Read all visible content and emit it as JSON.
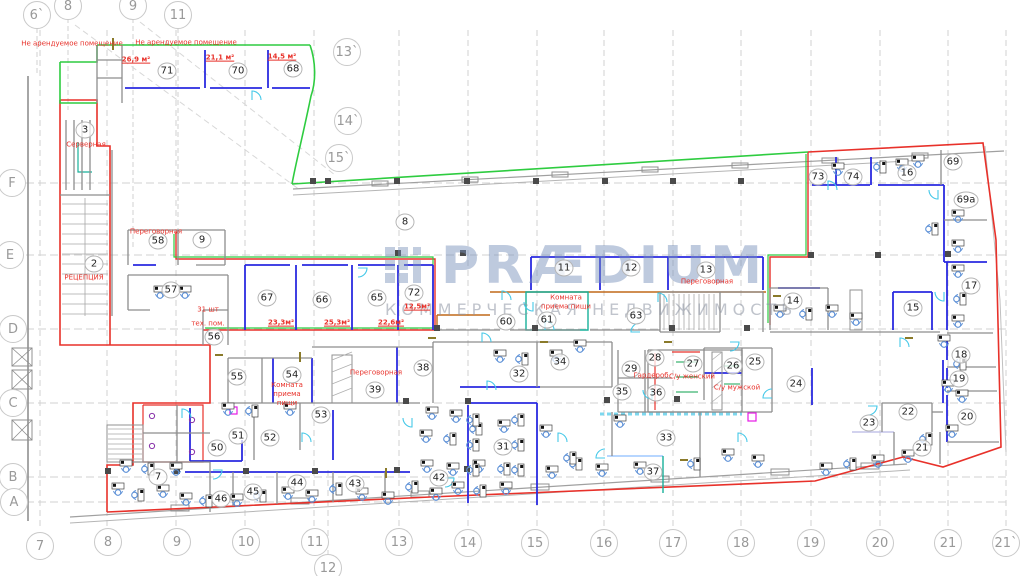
{
  "watermark": {
    "brand": "PRÆDIUM",
    "subtitle": "КОММЕРЧЕСКАЯ НЕДВИЖИМОСТЬ"
  },
  "colors": {
    "lease_boundary_red": "#e8312a",
    "tenant_boundary_green": "#2ecc40",
    "partition_blue": "#2a2ae0",
    "corridor_orange": "#c06818",
    "furniture_blue": "#5b8fd6",
    "door_cyan": "#45c8e8",
    "annotation_red": "#e8312a",
    "grid_gray": "#c9c9c9"
  },
  "grid_axes": [
    {
      "t": "6`",
      "x": 37,
      "y": 15
    },
    {
      "t": "8",
      "x": 68,
      "y": 6
    },
    {
      "t": "9",
      "x": 133,
      "y": 6
    },
    {
      "t": "11",
      "x": 178,
      "y": 15
    },
    {
      "t": "13`",
      "x": 347,
      "y": 52
    },
    {
      "t": "14`",
      "x": 348,
      "y": 121
    },
    {
      "t": "15`",
      "x": 339,
      "y": 158
    },
    {
      "t": "7",
      "x": 40,
      "y": 546
    },
    {
      "t": "8",
      "x": 108,
      "y": 542
    },
    {
      "t": "9",
      "x": 177,
      "y": 542
    },
    {
      "t": "10",
      "x": 246,
      "y": 542
    },
    {
      "t": "11",
      "x": 315,
      "y": 542
    },
    {
      "t": "12",
      "x": 328,
      "y": 568
    },
    {
      "t": "13",
      "x": 399,
      "y": 542
    },
    {
      "t": "14",
      "x": 468,
      "y": 543
    },
    {
      "t": "15",
      "x": 535,
      "y": 543
    },
    {
      "t": "16",
      "x": 604,
      "y": 543
    },
    {
      "t": "17",
      "x": 673,
      "y": 543
    },
    {
      "t": "18",
      "x": 741,
      "y": 543
    },
    {
      "t": "19",
      "x": 811,
      "y": 543
    },
    {
      "t": "20",
      "x": 880,
      "y": 543
    },
    {
      "t": "21",
      "x": 948,
      "y": 543
    },
    {
      "t": "21`",
      "x": 1006,
      "y": 543
    },
    {
      "t": "F",
      "x": 12,
      "y": 183
    },
    {
      "t": "E",
      "x": 10,
      "y": 255
    },
    {
      "t": "D",
      "x": 13,
      "y": 329
    },
    {
      "t": "C",
      "x": 13,
      "y": 403
    },
    {
      "t": "B",
      "x": 13,
      "y": 477
    },
    {
      "t": "A",
      "x": 14,
      "y": 502
    }
  ],
  "rooms": [
    {
      "n": "71",
      "x": 167,
      "y": 71
    },
    {
      "n": "70",
      "x": 238,
      "y": 71
    },
    {
      "n": "68",
      "x": 293,
      "y": 69
    },
    {
      "n": "3",
      "x": 85,
      "y": 130
    },
    {
      "n": "2",
      "x": 94,
      "y": 264
    },
    {
      "n": "58",
      "x": 158,
      "y": 241
    },
    {
      "n": "9",
      "x": 202,
      "y": 240
    },
    {
      "n": "8",
      "x": 405,
      "y": 222
    },
    {
      "n": "57",
      "x": 171,
      "y": 290
    },
    {
      "n": "56",
      "x": 214,
      "y": 337
    },
    {
      "n": "67",
      "x": 267,
      "y": 298
    },
    {
      "n": "66",
      "x": 322,
      "y": 300
    },
    {
      "n": "65",
      "x": 377,
      "y": 298
    },
    {
      "n": "72",
      "x": 414,
      "y": 293
    },
    {
      "n": "60",
      "x": 506,
      "y": 322
    },
    {
      "n": "61",
      "x": 547,
      "y": 320
    },
    {
      "n": "63",
      "x": 636,
      "y": 316
    },
    {
      "n": "11",
      "x": 564,
      "y": 268
    },
    {
      "n": "12",
      "x": 631,
      "y": 268
    },
    {
      "n": "13",
      "x": 706,
      "y": 270
    },
    {
      "n": "73",
      "x": 818,
      "y": 177
    },
    {
      "n": "74",
      "x": 853,
      "y": 177
    },
    {
      "n": "16",
      "x": 907,
      "y": 173
    },
    {
      "n": "69",
      "x": 953,
      "y": 162
    },
    {
      "n": "69a",
      "x": 966,
      "y": 200
    },
    {
      "n": "17",
      "x": 971,
      "y": 286
    },
    {
      "n": "14",
      "x": 793,
      "y": 301
    },
    {
      "n": "15",
      "x": 913,
      "y": 308
    },
    {
      "n": "18",
      "x": 961,
      "y": 355
    },
    {
      "n": "19",
      "x": 959,
      "y": 379
    },
    {
      "n": "20",
      "x": 967,
      "y": 417
    },
    {
      "n": "22",
      "x": 908,
      "y": 412
    },
    {
      "n": "23",
      "x": 869,
      "y": 423
    },
    {
      "n": "21",
      "x": 922,
      "y": 448
    },
    {
      "n": "24",
      "x": 796,
      "y": 384
    },
    {
      "n": "25",
      "x": 755,
      "y": 362
    },
    {
      "n": "26",
      "x": 733,
      "y": 366
    },
    {
      "n": "27",
      "x": 693,
      "y": 364
    },
    {
      "n": "28",
      "x": 655,
      "y": 358
    },
    {
      "n": "29",
      "x": 631,
      "y": 369
    },
    {
      "n": "35",
      "x": 622,
      "y": 392
    },
    {
      "n": "36",
      "x": 656,
      "y": 393
    },
    {
      "n": "33",
      "x": 666,
      "y": 438
    },
    {
      "n": "37",
      "x": 653,
      "y": 472
    },
    {
      "n": "34",
      "x": 560,
      "y": 362
    },
    {
      "n": "32",
      "x": 519,
      "y": 374
    },
    {
      "n": "38",
      "x": 423,
      "y": 368
    },
    {
      "n": "31",
      "x": 503,
      "y": 447
    },
    {
      "n": "42",
      "x": 439,
      "y": 478
    },
    {
      "n": "39",
      "x": 375,
      "y": 390
    },
    {
      "n": "54",
      "x": 292,
      "y": 375
    },
    {
      "n": "55",
      "x": 237,
      "y": 377
    },
    {
      "n": "53",
      "x": 321,
      "y": 415
    },
    {
      "n": "51",
      "x": 238,
      "y": 436
    },
    {
      "n": "52",
      "x": 270,
      "y": 438
    },
    {
      "n": "50",
      "x": 217,
      "y": 448
    },
    {
      "n": "7",
      "x": 158,
      "y": 477
    },
    {
      "n": "46",
      "x": 221,
      "y": 499
    },
    {
      "n": "45",
      "x": 253,
      "y": 492
    },
    {
      "n": "44",
      "x": 297,
      "y": 483
    },
    {
      "n": "43",
      "x": 355,
      "y": 484
    }
  ],
  "annotations": [
    {
      "t": "Не арендуемое помещение",
      "x": 72,
      "y": 44
    },
    {
      "t": "Не арендуемое помещение",
      "x": 186,
      "y": 43
    },
    {
      "t": "26,9 м²",
      "x": 136,
      "y": 60,
      "u": 1
    },
    {
      "t": "21,1 м²",
      "x": 220,
      "y": 58,
      "u": 1
    },
    {
      "t": "14,5 м²",
      "x": 282,
      "y": 57,
      "u": 1
    },
    {
      "t": "Серверная",
      "x": 86,
      "y": 145
    },
    {
      "t": "Переговорная",
      "x": 156,
      "y": 232
    },
    {
      "t": "РЕЦЕПЦИЯ",
      "x": 84,
      "y": 278
    },
    {
      "t": "12,5м²",
      "x": 417,
      "y": 307,
      "u": 1
    },
    {
      "t": "23,3м²",
      "x": 281,
      "y": 323,
      "u": 1
    },
    {
      "t": "25,3м²",
      "x": 337,
      "y": 323,
      "u": 1
    },
    {
      "t": "22,6м²",
      "x": 391,
      "y": 323,
      "u": 1
    },
    {
      "t": "Комната\nприема пищи",
      "x": 566,
      "y": 302
    },
    {
      "t": "Переговорная",
      "x": 707,
      "y": 282
    },
    {
      "t": "Переговорная",
      "x": 376,
      "y": 373
    },
    {
      "t": "Комната\nприема\nпищи",
      "x": 287,
      "y": 394
    },
    {
      "t": "Гардероб",
      "x": 651,
      "y": 376
    },
    {
      "t": "С/у женский",
      "x": 692,
      "y": 377
    },
    {
      "t": "С/у мужской",
      "x": 737,
      "y": 388
    },
    {
      "t": "31 шт",
      "x": 208,
      "y": 310
    },
    {
      "t": "тех. пом.",
      "x": 208,
      "y": 324
    }
  ]
}
